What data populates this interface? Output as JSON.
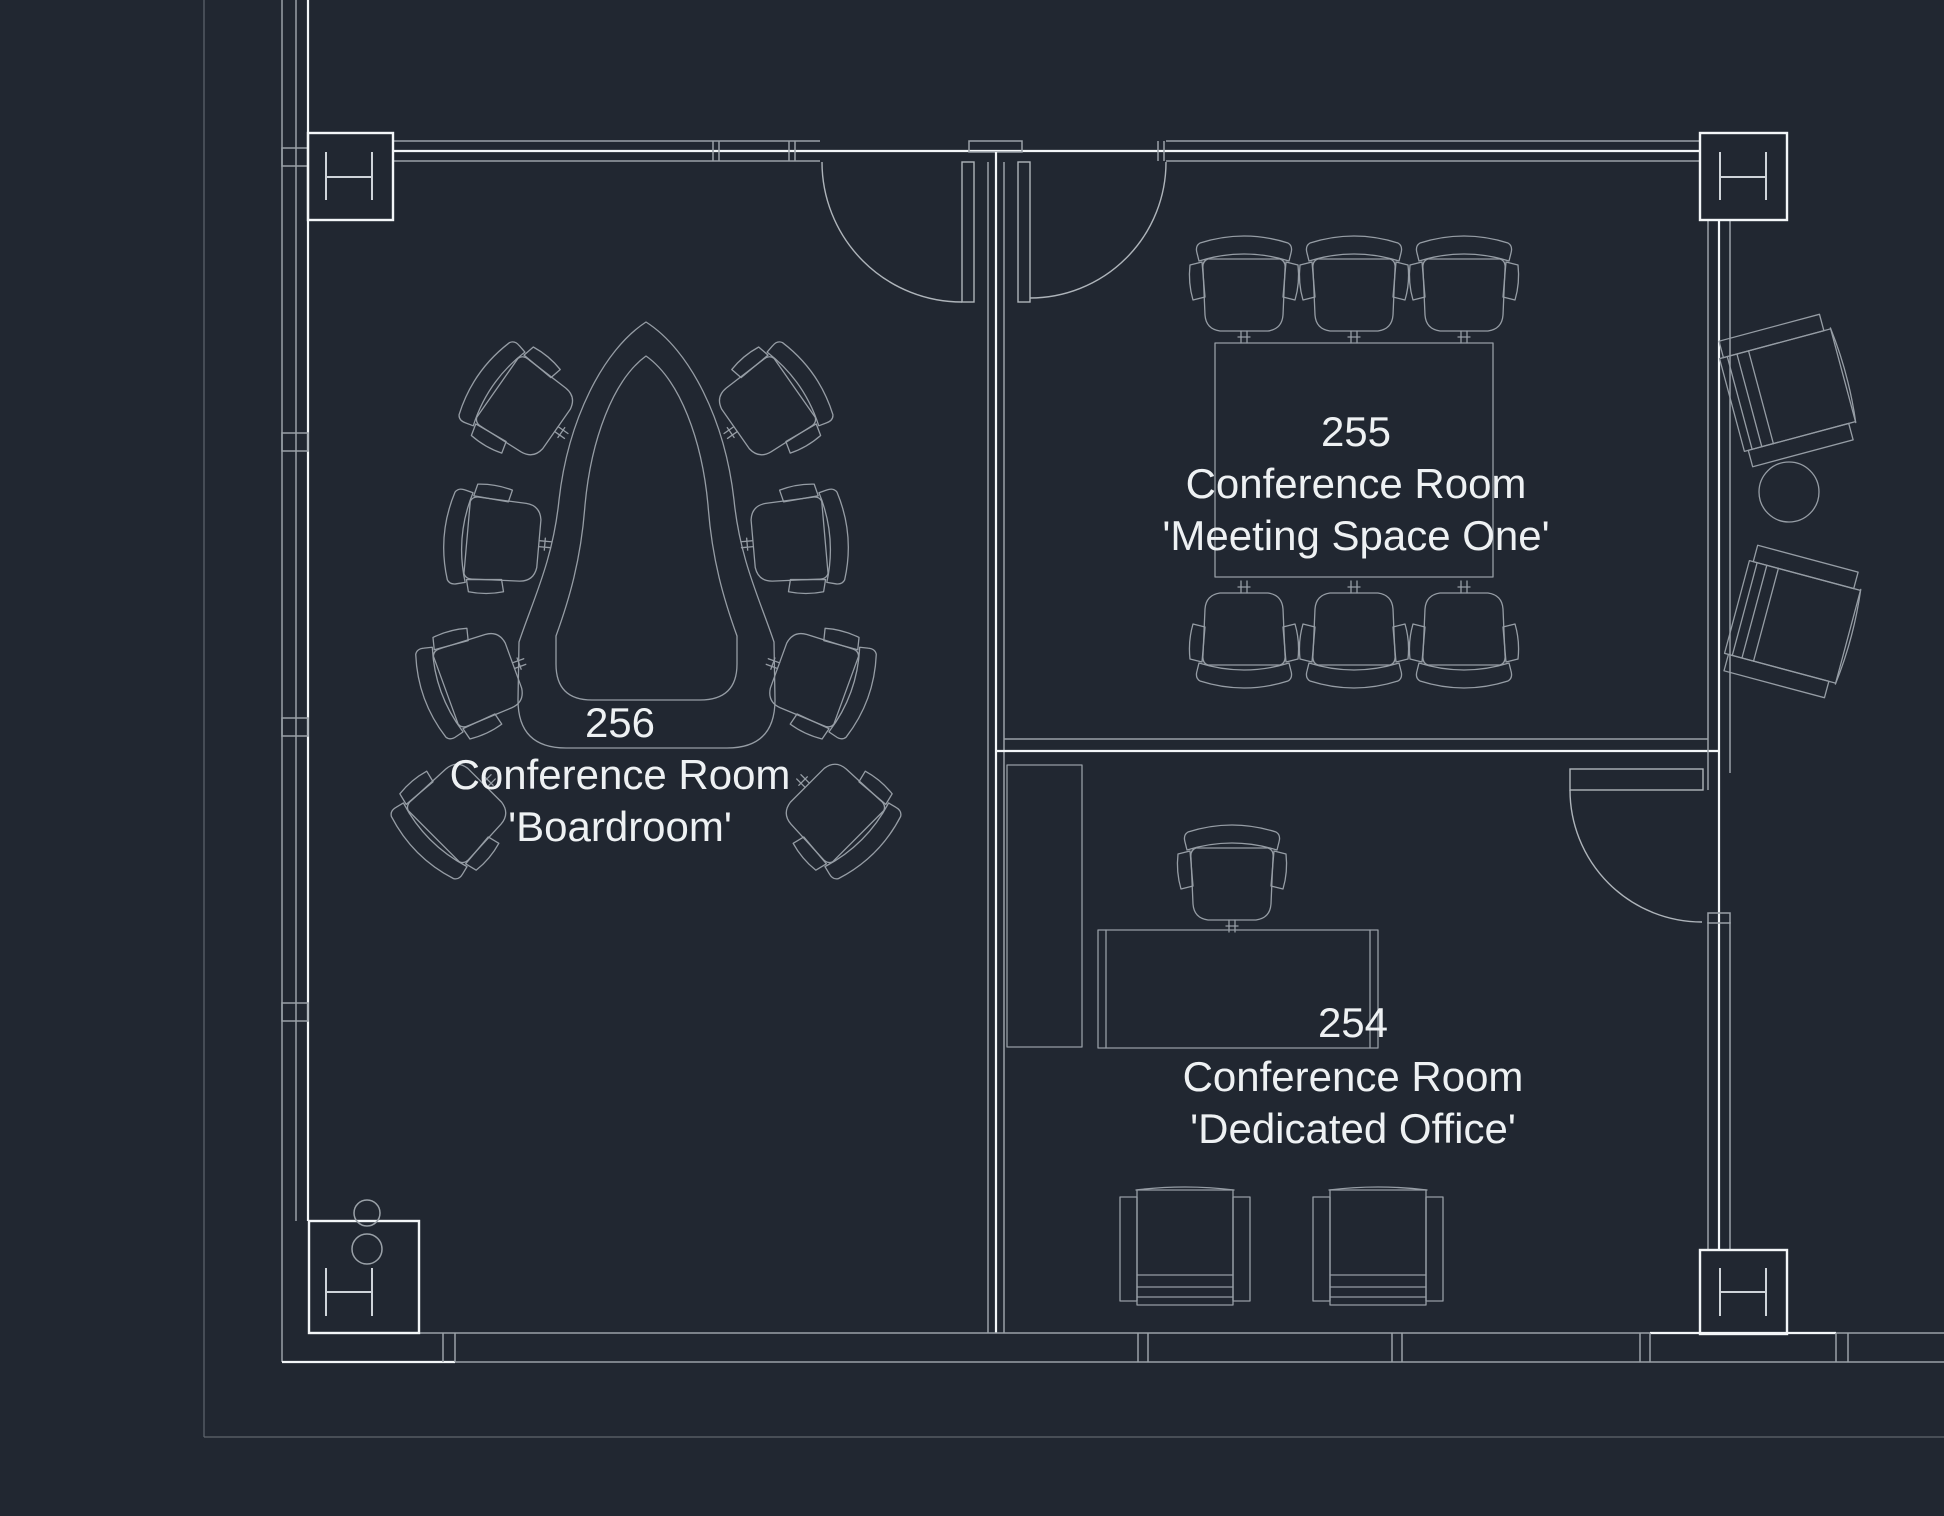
{
  "canvas": {
    "background_color": "#212731",
    "line_color": "#9aa1a8",
    "bright_line_color": "#f3f6f8",
    "text_color": "#eef1f3"
  },
  "rooms": [
    {
      "number": "256",
      "type": "Conference Room",
      "alias": "'Boardroom'",
      "furniture": {
        "horseshoe_conference_table": 1,
        "office_chairs": 8
      }
    },
    {
      "number": "255",
      "type": "Conference Room",
      "alias": "'Meeting Space One'",
      "furniture": {
        "rectangular_conference_table": 1,
        "office_chairs": 6
      }
    },
    {
      "number": "254",
      "type": "Conference Room",
      "alias": "'Dedicated Office'",
      "furniture": {
        "desk": 1,
        "office_chair": 1,
        "guest_chairs": 2,
        "side_cabinet": 1
      }
    }
  ],
  "lounge_area": {
    "armchairs": 2,
    "round_side_table": 1
  },
  "column_markers": {
    "symbol": "H",
    "count": 4
  },
  "doors": {
    "count": 3
  }
}
